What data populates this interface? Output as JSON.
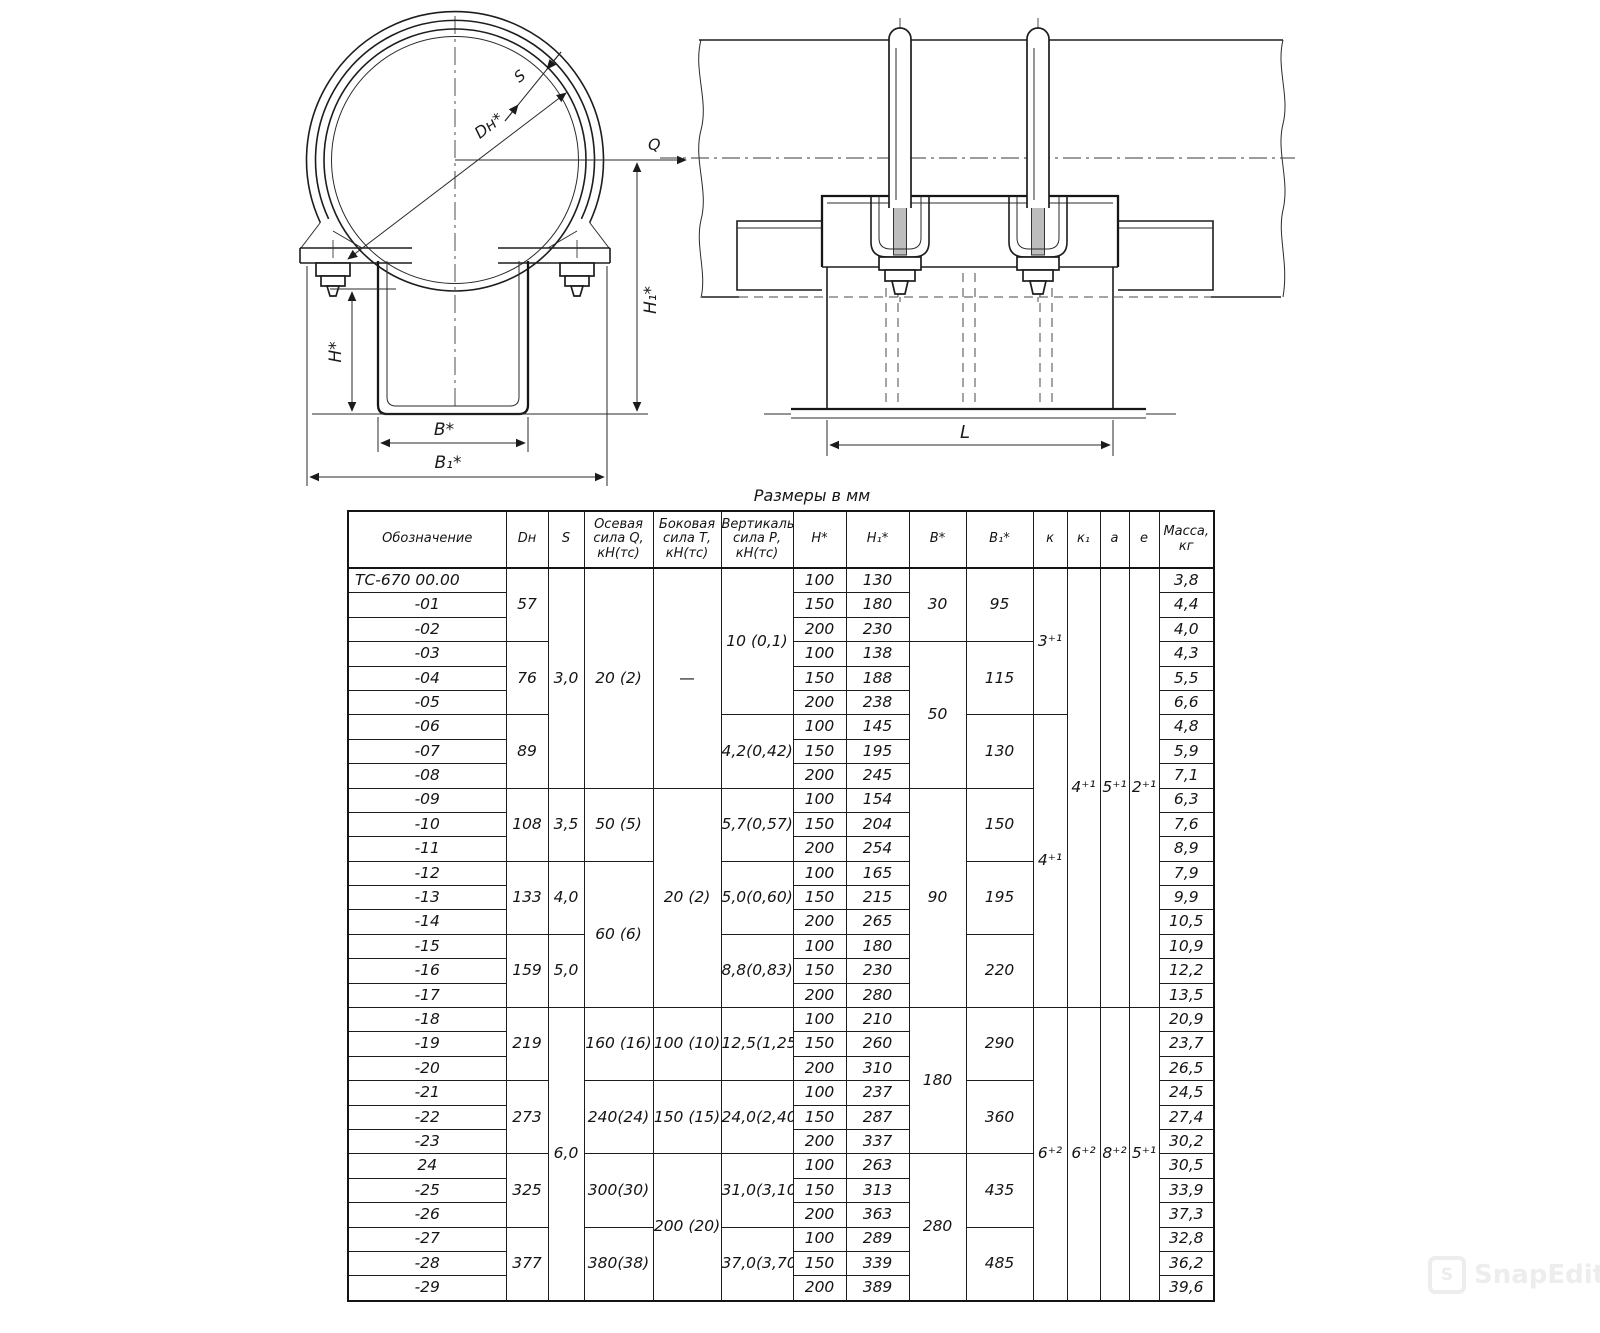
{
  "table_title": "Размеры в мм",
  "front_view": {
    "labels": {
      "s": "S",
      "dn": "Dн*",
      "q": "Q",
      "h": "Н*",
      "h1": "Н₁*",
      "b": "В*",
      "b1": "В₁*"
    }
  },
  "side_view": {
    "labels": {
      "l": "L"
    }
  },
  "watermark": {
    "text": "SnapEdit",
    "icon": "S"
  },
  "table": {
    "columns": [
      {
        "id": "obz",
        "label": "Обозначение"
      },
      {
        "id": "dn",
        "label": "Dн"
      },
      {
        "id": "s",
        "label": "S"
      },
      {
        "id": "q",
        "label": "Осевая\nсила Q,\nкН(тс)"
      },
      {
        "id": "t",
        "label": "Боковая\nсила Т,\nкН(тс)"
      },
      {
        "id": "p",
        "label": "Вертикальная\nсила Р,\nкН(тс)"
      },
      {
        "id": "h",
        "label": "Н*"
      },
      {
        "id": "h1",
        "label": "Н₁*"
      },
      {
        "id": "b",
        "label": "В*"
      },
      {
        "id": "b1",
        "label": "В₁*"
      },
      {
        "id": "k",
        "label": "к"
      },
      {
        "id": "k1",
        "label": "к₁"
      },
      {
        "id": "a",
        "label": "а"
      },
      {
        "id": "e",
        "label": "е"
      },
      {
        "id": "m",
        "label": "Масса,\nкг"
      }
    ],
    "rows": [
      {
        "cells": [
          {
            "col": "obz",
            "t": "ТС-670 00.00",
            "al": "l"
          },
          {
            "col": "dn",
            "t": "57",
            "rs": 3
          },
          {
            "col": "s",
            "t": "3,0",
            "rs": 9
          },
          {
            "col": "q",
            "t": "20 (2)",
            "rs": 9
          },
          {
            "col": "t",
            "t": "—",
            "rs": 9
          },
          {
            "col": "p",
            "t": "10 (0,1)",
            "rs": 6
          },
          {
            "col": "h",
            "t": "100"
          },
          {
            "col": "h1",
            "t": "130"
          },
          {
            "col": "b",
            "t": "30",
            "rs": 3
          },
          {
            "col": "b1",
            "t": "95",
            "rs": 3
          },
          {
            "col": "k",
            "t": "3⁺¹",
            "rs": 6
          },
          {
            "col": "k1",
            "t": "4⁺¹",
            "rs": 18
          },
          {
            "col": "a",
            "t": "5⁺¹",
            "rs": 18
          },
          {
            "col": "e",
            "t": "2⁺¹",
            "rs": 18
          },
          {
            "col": "m",
            "t": "3,8"
          }
        ]
      },
      {
        "cells": [
          {
            "col": "obz",
            "t": "-01"
          },
          {
            "col": "h",
            "t": "150"
          },
          {
            "col": "h1",
            "t": "180"
          },
          {
            "col": "m",
            "t": "4,4"
          }
        ]
      },
      {
        "cells": [
          {
            "col": "obz",
            "t": "-02"
          },
          {
            "col": "h",
            "t": "200"
          },
          {
            "col": "h1",
            "t": "230"
          },
          {
            "col": "m",
            "t": "4,0"
          }
        ]
      },
      {
        "cells": [
          {
            "col": "obz",
            "t": "-03"
          },
          {
            "col": "dn",
            "t": "76",
            "rs": 3
          },
          {
            "col": "h",
            "t": "100"
          },
          {
            "col": "h1",
            "t": "138"
          },
          {
            "col": "b",
            "t": "50",
            "rs": 6
          },
          {
            "col": "b1",
            "t": "115",
            "rs": 3
          },
          {
            "col": "m",
            "t": "4,3"
          }
        ]
      },
      {
        "cells": [
          {
            "col": "obz",
            "t": "-04"
          },
          {
            "col": "h",
            "t": "150"
          },
          {
            "col": "h1",
            "t": "188"
          },
          {
            "col": "m",
            "t": "5,5"
          }
        ]
      },
      {
        "cells": [
          {
            "col": "obz",
            "t": "-05"
          },
          {
            "col": "h",
            "t": "200"
          },
          {
            "col": "h1",
            "t": "238"
          },
          {
            "col": "m",
            "t": "6,6"
          }
        ]
      },
      {
        "cells": [
          {
            "col": "obz",
            "t": "-06"
          },
          {
            "col": "dn",
            "t": "89",
            "rs": 3
          },
          {
            "col": "p",
            "t": "4,2(0,42)",
            "rs": 3
          },
          {
            "col": "h",
            "t": "100"
          },
          {
            "col": "h1",
            "t": "145"
          },
          {
            "col": "b1",
            "t": "130",
            "rs": 3
          },
          {
            "col": "k",
            "t": "4⁺¹",
            "rs": 12
          },
          {
            "col": "m",
            "t": "4,8"
          }
        ]
      },
      {
        "cells": [
          {
            "col": "obz",
            "t": "-07"
          },
          {
            "col": "h",
            "t": "150"
          },
          {
            "col": "h1",
            "t": "195"
          },
          {
            "col": "m",
            "t": "5,9"
          }
        ]
      },
      {
        "cells": [
          {
            "col": "obz",
            "t": "-08"
          },
          {
            "col": "h",
            "t": "200"
          },
          {
            "col": "h1",
            "t": "245"
          },
          {
            "col": "m",
            "t": "7,1"
          }
        ]
      },
      {
        "cells": [
          {
            "col": "obz",
            "t": "-09"
          },
          {
            "col": "dn",
            "t": "108",
            "rs": 3
          },
          {
            "col": "s",
            "t": "3,5",
            "rs": 3
          },
          {
            "col": "q",
            "t": "50 (5)",
            "rs": 3
          },
          {
            "col": "t",
            "t": "20 (2)",
            "rs": 9
          },
          {
            "col": "p",
            "t": "5,7(0,57)",
            "rs": 3
          },
          {
            "col": "h",
            "t": "100"
          },
          {
            "col": "h1",
            "t": "154"
          },
          {
            "col": "b",
            "t": "90",
            "rs": 9
          },
          {
            "col": "b1",
            "t": "150",
            "rs": 3
          },
          {
            "col": "m",
            "t": "6,3"
          }
        ]
      },
      {
        "cells": [
          {
            "col": "obz",
            "t": "-10"
          },
          {
            "col": "h",
            "t": "150"
          },
          {
            "col": "h1",
            "t": "204"
          },
          {
            "col": "m",
            "t": "7,6"
          }
        ]
      },
      {
        "cells": [
          {
            "col": "obz",
            "t": "-11"
          },
          {
            "col": "h",
            "t": "200"
          },
          {
            "col": "h1",
            "t": "254"
          },
          {
            "col": "m",
            "t": "8,9"
          }
        ]
      },
      {
        "cells": [
          {
            "col": "obz",
            "t": "-12"
          },
          {
            "col": "dn",
            "t": "133",
            "rs": 3
          },
          {
            "col": "s",
            "t": "4,0",
            "rs": 3
          },
          {
            "col": "q",
            "t": "60 (6)",
            "rs": 6
          },
          {
            "col": "p",
            "t": "5,0(0,60)",
            "rs": 3
          },
          {
            "col": "h",
            "t": "100"
          },
          {
            "col": "h1",
            "t": "165"
          },
          {
            "col": "b1",
            "t": "195",
            "rs": 3
          },
          {
            "col": "m",
            "t": "7,9"
          }
        ]
      },
      {
        "cells": [
          {
            "col": "obz",
            "t": "-13"
          },
          {
            "col": "h",
            "t": "150"
          },
          {
            "col": "h1",
            "t": "215"
          },
          {
            "col": "m",
            "t": "9,9"
          }
        ]
      },
      {
        "cells": [
          {
            "col": "obz",
            "t": "-14"
          },
          {
            "col": "h",
            "t": "200"
          },
          {
            "col": "h1",
            "t": "265"
          },
          {
            "col": "m",
            "t": "10,5"
          }
        ]
      },
      {
        "cells": [
          {
            "col": "obz",
            "t": "-15"
          },
          {
            "col": "dn",
            "t": "159",
            "rs": 3
          },
          {
            "col": "s",
            "t": "5,0",
            "rs": 3
          },
          {
            "col": "p",
            "t": "8,8(0,83)",
            "rs": 3
          },
          {
            "col": "h",
            "t": "100"
          },
          {
            "col": "h1",
            "t": "180"
          },
          {
            "col": "b1",
            "t": "220",
            "rs": 3
          },
          {
            "col": "m",
            "t": "10,9"
          }
        ]
      },
      {
        "cells": [
          {
            "col": "obz",
            "t": "-16"
          },
          {
            "col": "h",
            "t": "150"
          },
          {
            "col": "h1",
            "t": "230"
          },
          {
            "col": "m",
            "t": "12,2"
          }
        ]
      },
      {
        "cells": [
          {
            "col": "obz",
            "t": "-17"
          },
          {
            "col": "h",
            "t": "200"
          },
          {
            "col": "h1",
            "t": "280"
          },
          {
            "col": "m",
            "t": "13,5"
          }
        ]
      },
      {
        "cells": [
          {
            "col": "obz",
            "t": "-18"
          },
          {
            "col": "dn",
            "t": "219",
            "rs": 3
          },
          {
            "col": "s",
            "t": "6,0",
            "rs": 12
          },
          {
            "col": "q",
            "t": "160 (16)",
            "rs": 3
          },
          {
            "col": "t",
            "t": "100 (10)",
            "rs": 3
          },
          {
            "col": "p",
            "t": "12,5(1,25)",
            "rs": 3
          },
          {
            "col": "h",
            "t": "100"
          },
          {
            "col": "h1",
            "t": "210"
          },
          {
            "col": "b",
            "t": "180",
            "rs": 6
          },
          {
            "col": "b1",
            "t": "290",
            "rs": 3
          },
          {
            "col": "k",
            "t": "6⁺²",
            "rs": 12
          },
          {
            "col": "k1",
            "t": "6⁺²",
            "rs": 12
          },
          {
            "col": "a",
            "t": "8⁺²",
            "rs": 12
          },
          {
            "col": "e",
            "t": "5⁺¹",
            "rs": 12
          },
          {
            "col": "m",
            "t": "20,9"
          }
        ]
      },
      {
        "cells": [
          {
            "col": "obz",
            "t": "-19"
          },
          {
            "col": "h",
            "t": "150"
          },
          {
            "col": "h1",
            "t": "260"
          },
          {
            "col": "m",
            "t": "23,7"
          }
        ]
      },
      {
        "cells": [
          {
            "col": "obz",
            "t": "-20"
          },
          {
            "col": "h",
            "t": "200"
          },
          {
            "col": "h1",
            "t": "310"
          },
          {
            "col": "m",
            "t": "26,5"
          }
        ]
      },
      {
        "cells": [
          {
            "col": "obz",
            "t": "-21"
          },
          {
            "col": "dn",
            "t": "273",
            "rs": 3
          },
          {
            "col": "q",
            "t": "240(24)",
            "rs": 3
          },
          {
            "col": "t",
            "t": "150 (15)",
            "rs": 3
          },
          {
            "col": "p",
            "t": "24,0(2,40)",
            "rs": 3
          },
          {
            "col": "h",
            "t": "100"
          },
          {
            "col": "h1",
            "t": "237"
          },
          {
            "col": "b1",
            "t": "360",
            "rs": 3
          },
          {
            "col": "m",
            "t": "24,5"
          }
        ]
      },
      {
        "cells": [
          {
            "col": "obz",
            "t": "-22"
          },
          {
            "col": "h",
            "t": "150"
          },
          {
            "col": "h1",
            "t": "287"
          },
          {
            "col": "m",
            "t": "27,4"
          }
        ]
      },
      {
        "cells": [
          {
            "col": "obz",
            "t": "-23"
          },
          {
            "col": "h",
            "t": "200"
          },
          {
            "col": "h1",
            "t": "337"
          },
          {
            "col": "m",
            "t": "30,2"
          }
        ]
      },
      {
        "cells": [
          {
            "col": "obz",
            "t": "24"
          },
          {
            "col": "dn",
            "t": "325",
            "rs": 3
          },
          {
            "col": "q",
            "t": "300(30)",
            "rs": 3
          },
          {
            "col": "t",
            "t": "200 (20)",
            "rs": 6
          },
          {
            "col": "p",
            "t": "31,0(3,10)",
            "rs": 3
          },
          {
            "col": "h",
            "t": "100"
          },
          {
            "col": "h1",
            "t": "263"
          },
          {
            "col": "b",
            "t": "280",
            "rs": 6
          },
          {
            "col": "b1",
            "t": "435",
            "rs": 3
          },
          {
            "col": "m",
            "t": "30,5"
          }
        ]
      },
      {
        "cells": [
          {
            "col": "obz",
            "t": "-25"
          },
          {
            "col": "h",
            "t": "150"
          },
          {
            "col": "h1",
            "t": "313"
          },
          {
            "col": "m",
            "t": "33,9"
          }
        ]
      },
      {
        "cells": [
          {
            "col": "obz",
            "t": "-26"
          },
          {
            "col": "h",
            "t": "200"
          },
          {
            "col": "h1",
            "t": "363"
          },
          {
            "col": "m",
            "t": "37,3"
          }
        ]
      },
      {
        "cells": [
          {
            "col": "obz",
            "t": "-27"
          },
          {
            "col": "dn",
            "t": "377",
            "rs": 3
          },
          {
            "col": "q",
            "t": "380(38)",
            "rs": 3
          },
          {
            "col": "p",
            "t": "37,0(3,70)",
            "rs": 3
          },
          {
            "col": "h",
            "t": "100"
          },
          {
            "col": "h1",
            "t": "289"
          },
          {
            "col": "b1",
            "t": "485",
            "rs": 3
          },
          {
            "col": "m",
            "t": "32,8"
          }
        ]
      },
      {
        "cells": [
          {
            "col": "obz",
            "t": "-28"
          },
          {
            "col": "h",
            "t": "150"
          },
          {
            "col": "h1",
            "t": "339"
          },
          {
            "col": "m",
            "t": "36,2"
          }
        ]
      },
      {
        "cells": [
          {
            "col": "obz",
            "t": "-29"
          },
          {
            "col": "h",
            "t": "200"
          },
          {
            "col": "h1",
            "t": "389"
          },
          {
            "col": "m",
            "t": "39,6"
          }
        ]
      }
    ]
  }
}
